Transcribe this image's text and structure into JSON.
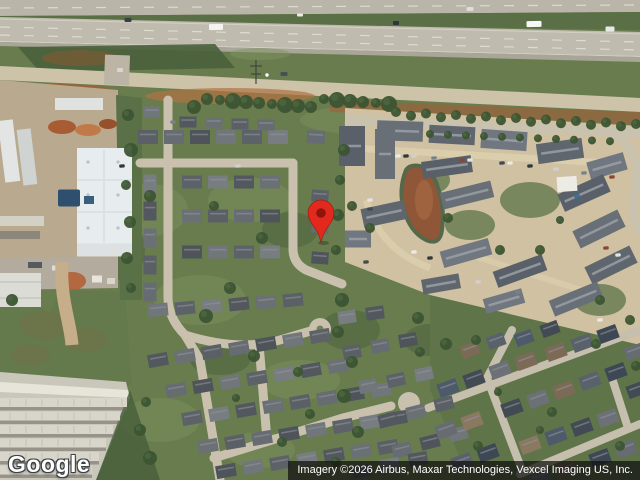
{
  "map": {
    "type": "satellite",
    "watermark": "Google",
    "attribution": "Imagery ©2026 Airbus, Maxar Technologies, Vexcel Imaging US, Inc.",
    "marker": {
      "label": "location-marker",
      "color": "#E3291D",
      "dot_color": "#8E150C"
    },
    "palette": {
      "grass": "#687C4E",
      "grass_dark": "#49603C",
      "grass_light": "#7E9160",
      "road": "#C9C1AE",
      "highway": "#BFBBAE",
      "dirt_tan": "#C0A987",
      "dirt_red": "#A35F38",
      "roof": "#565B60",
      "roof_light": "#9AA0A6",
      "pond": "#8F5637",
      "tree": "#3C5433",
      "building_white": "#E7ECEF",
      "storage": "#D8D5CA"
    }
  }
}
